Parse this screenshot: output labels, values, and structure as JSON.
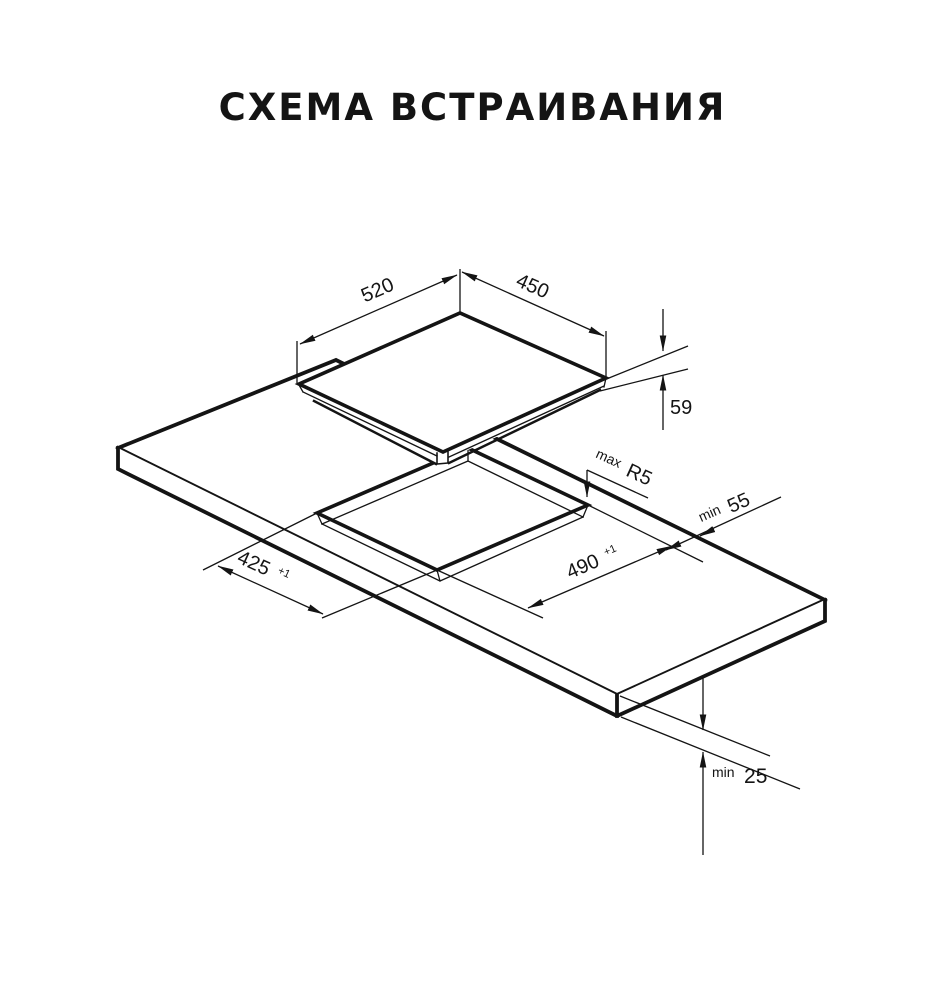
{
  "title": "СХЕМА ВСТРАИВАНИЯ",
  "dimensions": {
    "hob_width": "520",
    "hob_depth": "450",
    "hob_height": "59",
    "cutout_width": "425",
    "cutout_width_tolerance": "+1",
    "cutout_depth": "490",
    "cutout_depth_tolerance": "+1",
    "corner_radius_prefix": "max",
    "corner_radius": "R5",
    "rear_clearance_prefix": "min",
    "rear_clearance": "55",
    "worktop_thickness_prefix": "min",
    "worktop_thickness": "25"
  },
  "colors": {
    "line": "#141414",
    "background": "#ffffff"
  }
}
